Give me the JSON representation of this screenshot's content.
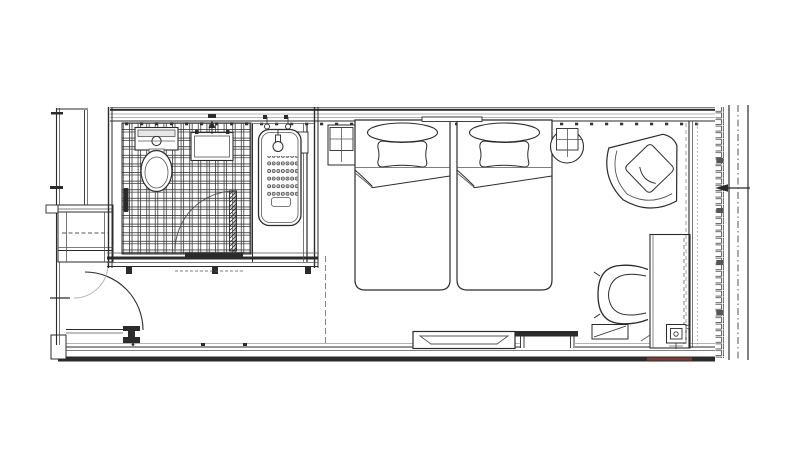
{
  "document": {
    "type": "architectural-floor-plan",
    "title": "Hotel twin guest room floor plan",
    "visible_text": []
  },
  "colors": {
    "background": "#ffffff",
    "line": "#2b2b2b",
    "line_mid": "#555555",
    "line_light": "#9a9a9a",
    "accent_red": "#7d3b35"
  },
  "rooms": [
    {
      "name": "bathroom",
      "features": [
        "toilet with cistern",
        "washbasin with faucet",
        "bathtub with hand shower",
        "anti-slip dot mat",
        "basketweave tiled floor",
        "hinged door with swing arc",
        "grab bar",
        "door threshold track"
      ]
    },
    {
      "name": "bedroom",
      "features": [
        "twin bed 1 with pillow and folded sheet",
        "twin bed 2 with pillow and folded sheet",
        "headboard panel",
        "nightstand with grid top",
        "round side table with grid top",
        "lounge armchair with cushion",
        "desk",
        "desk chair",
        "luggage rack",
        "floor outlet box",
        "wall niche shelf",
        "wall recess duct"
      ]
    },
    {
      "name": "entry",
      "features": [
        "entry door with quarter-circle swing arc",
        "secondary light swing arc",
        "closet with hanging rod (dashed)",
        "service shaft"
      ]
    },
    {
      "name": "facade",
      "features": [
        "hatched exterior window wall",
        "mullion lines",
        "center dash-dot line",
        "leftward section arrow",
        "dark red wall segment"
      ]
    }
  ]
}
